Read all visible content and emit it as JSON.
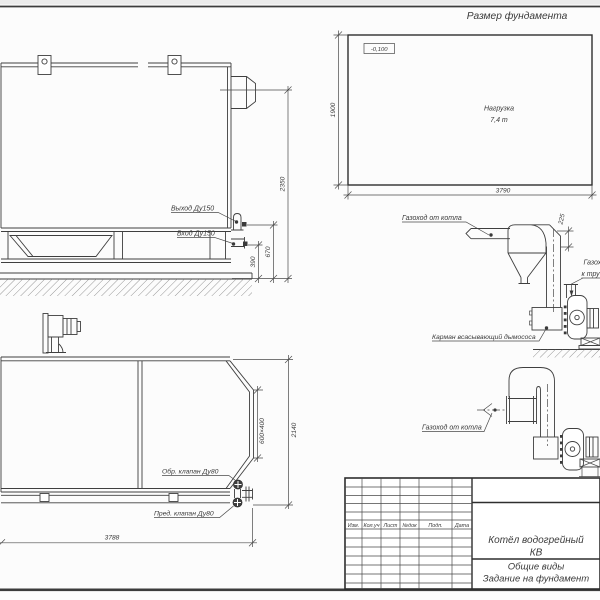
{
  "sheet": {
    "background": "#fcfcfc",
    "line_color": "#3f3f3f",
    "text_color": "#3a3a3a"
  },
  "foundation_plan": {
    "title": "Размер фундамента",
    "elevation_mark": "-0,100",
    "load_line1": "Нагрузка",
    "load_line2": "7,4 т",
    "dim_height": "1900",
    "dim_width": "3790"
  },
  "boiler_side_view": {
    "label_outlet": "Выход Ду150",
    "label_inlet": "Вход Ду150",
    "dim_total_height": "2350",
    "dim_outlet_height": "670",
    "dim_inlet_height": "390"
  },
  "boiler_plan_view": {
    "label_check_valve": "Обр. клапан Ду80",
    "label_safety_valve": "Пред. клапан Ду80",
    "dim_length": "3788",
    "dim_width": "2140",
    "dim_flue_opening": "600×400"
  },
  "flue_upper": {
    "label_from_boiler": "Газоход от котла",
    "dim_offset": "225",
    "label_to_stack_line1": "Газоход",
    "label_to_stack_line2": "к трубе",
    "label_pocket": "Карман всасывающий дымососа"
  },
  "flue_lower": {
    "label_from_boiler": "Газоход от котла"
  },
  "title_block": {
    "headers": [
      "Изм.",
      "Кол.уч",
      "Лист",
      "№док",
      "Подп.",
      "Дата"
    ],
    "product_line1": "Котёл водогрейный",
    "product_line2": "КВ",
    "doc_line1": "Общие виды",
    "doc_line2": "Задание на фундамент"
  }
}
